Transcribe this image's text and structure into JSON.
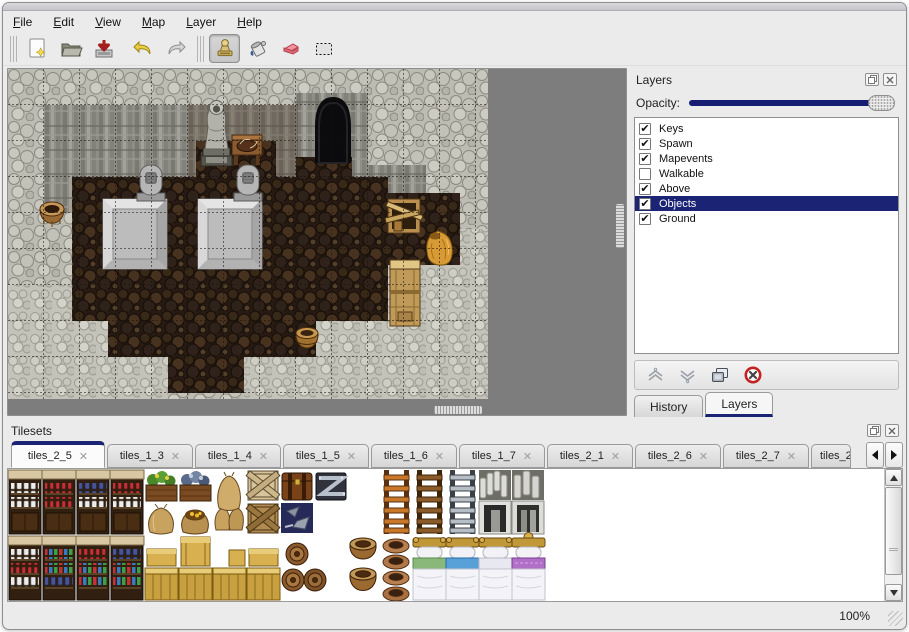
{
  "menubar": {
    "items": [
      {
        "label": "File"
      },
      {
        "label": "Edit"
      },
      {
        "label": "View"
      },
      {
        "label": "Map"
      },
      {
        "label": "Layer"
      },
      {
        "label": "Help"
      }
    ]
  },
  "toolbar": {
    "buttons": [
      {
        "name": "new-map"
      },
      {
        "name": "open-map"
      },
      {
        "name": "save-map"
      },
      {
        "name": "undo"
      },
      {
        "name": "redo"
      },
      {
        "name": "stamp-tool",
        "active": true
      },
      {
        "name": "fill-tool"
      },
      {
        "name": "eraser-tool"
      },
      {
        "name": "rect-select-tool"
      }
    ]
  },
  "layers_panel": {
    "title": "Layers",
    "opacity_label": "Opacity:",
    "opacity_value_percent": 100,
    "layers": [
      {
        "label": "Keys",
        "checked": true,
        "selected": false
      },
      {
        "label": "Spawn",
        "checked": true,
        "selected": false
      },
      {
        "label": "Mapevents",
        "checked": true,
        "selected": false
      },
      {
        "label": "Walkable",
        "checked": false,
        "selected": false
      },
      {
        "label": "Above",
        "checked": true,
        "selected": false
      },
      {
        "label": "Objects",
        "checked": true,
        "selected": true
      },
      {
        "label": "Ground",
        "checked": true,
        "selected": false
      }
    ],
    "buttons": [
      {
        "name": "move-layer-up"
      },
      {
        "name": "move-layer-down"
      },
      {
        "name": "duplicate-layer"
      },
      {
        "name": "delete-layer"
      }
    ],
    "tabs": [
      {
        "label": "History",
        "active": false
      },
      {
        "label": "Layers",
        "active": true
      }
    ]
  },
  "tilesets_panel": {
    "title": "Tilesets",
    "tabs": [
      {
        "label": "tiles_2_5",
        "active": true
      },
      {
        "label": "tiles_1_3",
        "active": false
      },
      {
        "label": "tiles_1_4",
        "active": false
      },
      {
        "label": "tiles_1_5",
        "active": false
      },
      {
        "label": "tiles_1_6",
        "active": false
      },
      {
        "label": "tiles_1_7",
        "active": false
      },
      {
        "label": "tiles_2_1",
        "active": false
      },
      {
        "label": "tiles_2_6",
        "active": false
      },
      {
        "label": "tiles_2_7",
        "active": false
      },
      {
        "label": "tiles_2",
        "active": false,
        "cut": true
      }
    ]
  },
  "statusbar": {
    "zoom_level": "100%"
  },
  "colors": {
    "accent": "#1b2375",
    "selection_bg": "#1b2375",
    "selection_text": "#ffffff",
    "map_void": "#7d7d7d"
  }
}
